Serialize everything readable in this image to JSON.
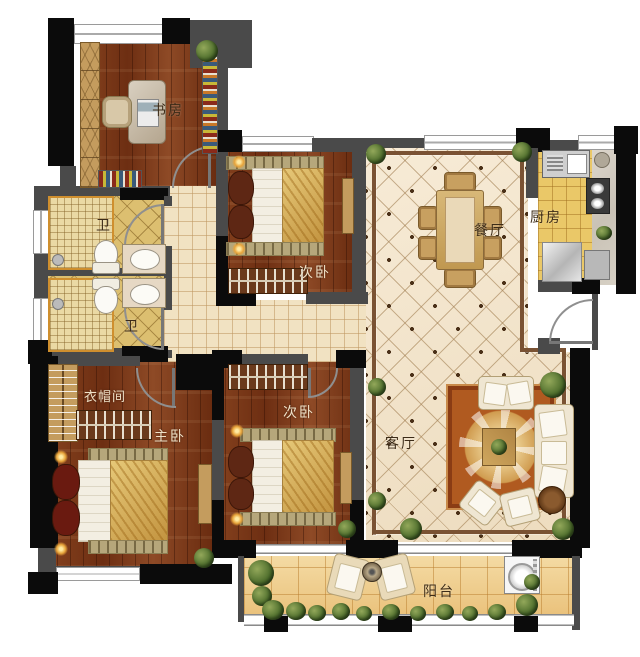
{
  "rooms": {
    "study": {
      "label": "书房"
    },
    "bath_top": {
      "label": "卫"
    },
    "bath_bottom": {
      "label": "卫"
    },
    "bedroom2_top": {
      "label": "次卧"
    },
    "dining": {
      "label": "餐厅"
    },
    "kitchen": {
      "label": "厨房"
    },
    "closet": {
      "label": "衣帽间"
    },
    "master": {
      "label": "主卧"
    },
    "bedroom2_bottom": {
      "label": "次卧"
    },
    "living": {
      "label": "客厅"
    },
    "balcony": {
      "label": "阳台"
    }
  },
  "palette": {
    "wall_gray": "#4a4a4a",
    "wall_black": "#0b0b0b",
    "wood_floor": "#7b3a1d",
    "bath_tile": "#dcbf70",
    "hall_tile": "#f1e2c2",
    "main_tile": "#f4e8d1",
    "balcony_tile": "#eccB86",
    "rug": "#b05a20",
    "cabinet_wood": "#c49c5e",
    "gold_fabric": "#d8b35c"
  }
}
